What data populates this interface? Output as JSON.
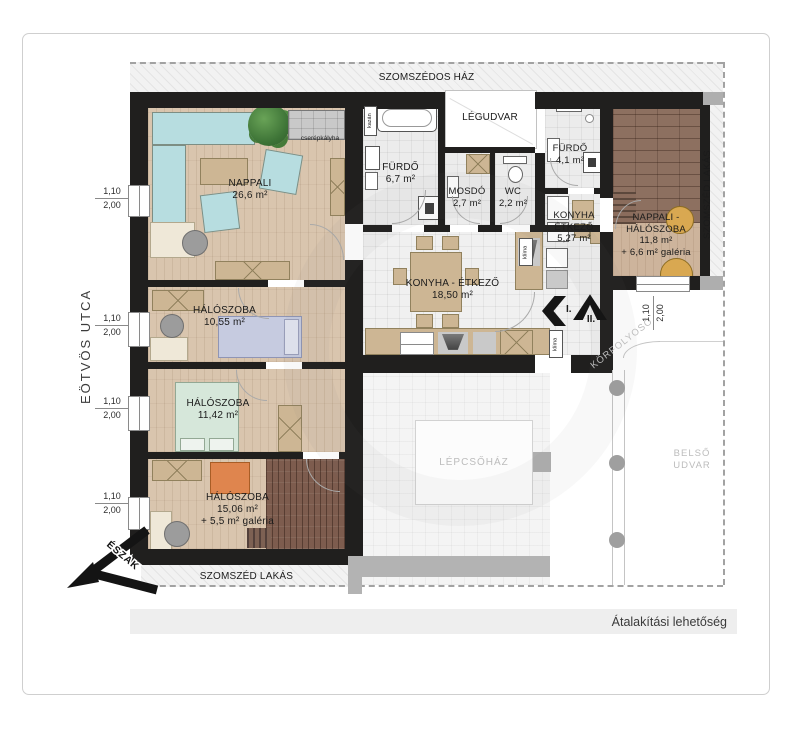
{
  "caption": {
    "text": "Átalakítási lehetőség"
  },
  "street": "EÖTVÖS UTCA",
  "north": "ÉSZAK",
  "neighbors": {
    "top": "SZOMSZÉDOS HÁZ",
    "right": "SZOMSZÉD LAKÁS",
    "bottom": "SZOMSZÉD LAKÁS"
  },
  "rooms": {
    "nappali": {
      "name": "NAPPALI",
      "area": "26,6 m²"
    },
    "halo1": {
      "name": "HÁLÓSZOBA",
      "area": "10,55 m²"
    },
    "halo2": {
      "name": "HÁLÓSZOBA",
      "area": "11,42 m²"
    },
    "halo3": {
      "name": "HÁLÓSZOBA",
      "area": "15,06 m²",
      "extra": "+ 5,5 m² galéria"
    },
    "furdo_nagy": {
      "name": "FÜRDŐ",
      "area": "6,7 m²"
    },
    "mosdo": {
      "name": "MOSDÓ",
      "area": "2,7 m²"
    },
    "wc": {
      "name": "WC",
      "area": "2,2 m²"
    },
    "legudvar": "LÉGUDVAR",
    "furdo_kis": {
      "name": "FÜRDŐ",
      "area": "4,1 m²"
    },
    "konyha_kis": {
      "line1": "KONYHA",
      "line2": "ÉTKEZŐ",
      "area": "5,27 m²"
    },
    "nappali_halo": {
      "line1": "NAPPALI -",
      "line2": "HÁLÓSZOBA",
      "area": "11,8 m²",
      "extra": "+ 6,6 m² galéria"
    },
    "konyha_nagy": {
      "name": "KONYHA - ÉTKEZŐ",
      "area": "18,50 m²"
    },
    "lepcsohaz": "LÉPCSŐHÁZ",
    "belso_udvar": {
      "line1": "BELSŐ",
      "line2": "UDVAR"
    },
    "korfolyoso": "KÖRFOLYOSÓ"
  },
  "annotations": {
    "cserepkalyha": "cserépkályha",
    "kazan": "kazán",
    "klima": "klíma",
    "route1": "I.",
    "route2": "II."
  },
  "dims": {
    "w": "1,10",
    "h": "2,00"
  },
  "colors": {
    "wall": "#201f1e",
    "wood_floor": "#d9c5ae",
    "gallery_floor": "#8d7060",
    "sofa_teal": "#b7dde0",
    "sofa_orange": "#df854e",
    "neighbor_gray": "#aeaeae"
  }
}
